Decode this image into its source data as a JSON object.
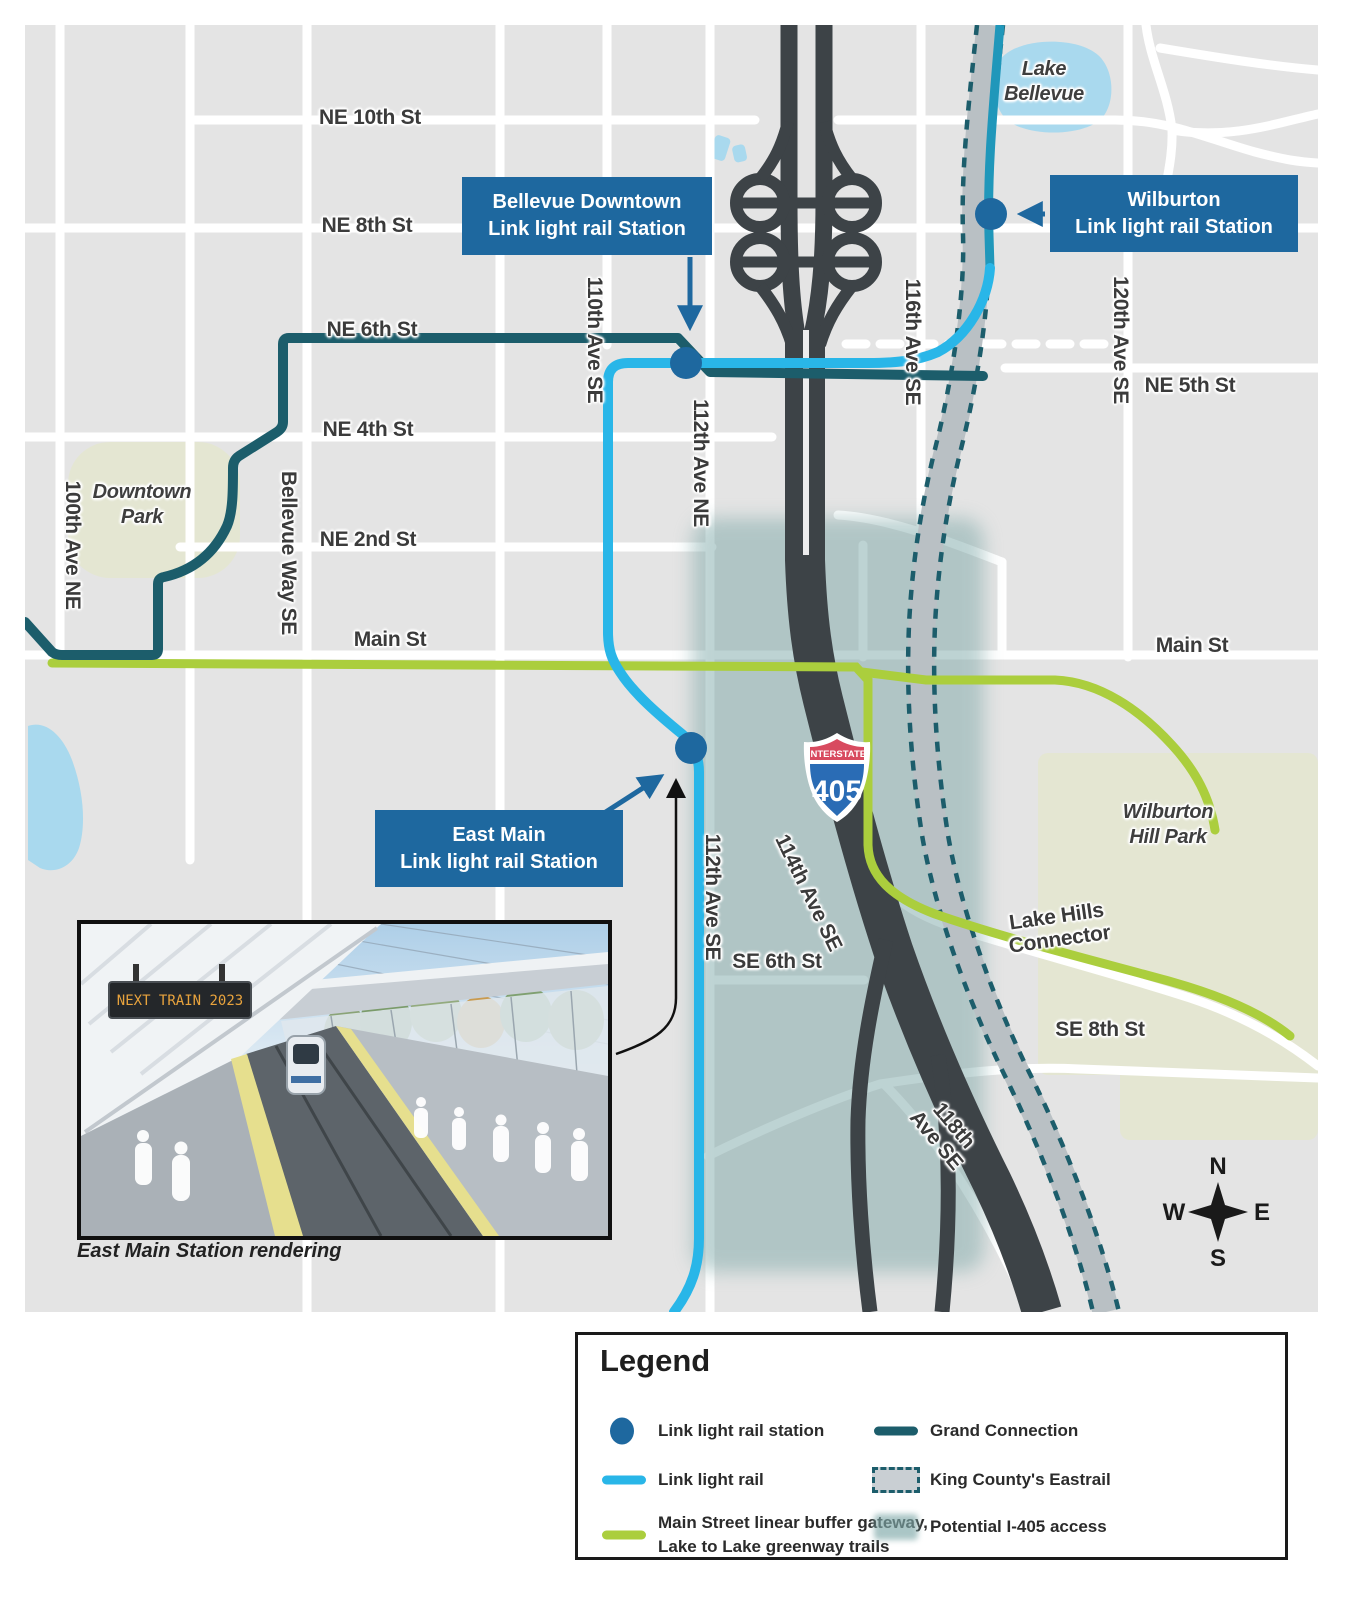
{
  "colors": {
    "rail": "#29b6e8",
    "rail-dark": "#2097ba",
    "grand": "#1c5d6b",
    "greenway": "#abce3d",
    "station": "#1e689f",
    "eastrail-band": "#b9c0c4",
    "access": "#7ea8a8",
    "park": "#e4e6d2",
    "lake": "#a9d9ee",
    "freeway": "#3d4347",
    "road": "#ffffff",
    "map-bg": "#e4e4e4",
    "label": "#3b3b3b"
  },
  "labels": {
    "ne10": "NE 10th St",
    "ne8": "NE 8th St",
    "ne6": "NE 6th St",
    "ne4": "NE 4th St",
    "ne2": "NE 2nd St",
    "main_w": "Main St",
    "main_e": "Main St",
    "ne5": "NE 5th St",
    "se6": "SE 6th St",
    "se8": "SE 8th St",
    "ave100": "100th Ave NE",
    "bellevue_way": "Bellevue Way SE",
    "ave110": "110th Ave SE",
    "ave112n": "112th Ave NE",
    "ave116": "116th Ave SE",
    "ave120": "120th Ave SE",
    "ave112s": "112th Ave SE",
    "ave114": "114th Ave SE",
    "ave118_l1": "118th",
    "ave118_l2": "Ave SE",
    "lakehills_l1": "Lake Hills",
    "lakehills_l2": "Connector"
  },
  "places": {
    "downtown_park": {
      "line1": "Downtown",
      "line2": "Park"
    },
    "lake_bellevue": {
      "line1": "Lake",
      "line2": "Bellevue"
    },
    "wilburton_hill_park": {
      "line1": "Wilburton",
      "line2": "Hill Park"
    }
  },
  "callouts": {
    "bellevue_downtown": {
      "line1": "Bellevue Downtown",
      "line2": "Link light rail Station"
    },
    "wilburton": {
      "line1": "Wilburton",
      "line2": "Link light rail Station"
    },
    "east_main": {
      "line1": "East Main",
      "line2": "Link light rail Station"
    }
  },
  "shield": {
    "top": "INTERSTATE",
    "number": "405"
  },
  "compass": {
    "n": "N",
    "e": "E",
    "s": "S",
    "w": "W"
  },
  "inset": {
    "sign": "NEXT TRAIN 2023",
    "caption": "East Main Station rendering"
  },
  "legend": {
    "title": "Legend",
    "items": {
      "station": "Link light rail station",
      "rail": "Link light rail",
      "greenway_line1": "Main Street linear buffer gateway,",
      "greenway_line2": "Lake to Lake greenway trails",
      "grand": "Grand Connection",
      "eastrail": "King County's Eastrail",
      "access": "Potential I-405 access"
    }
  }
}
